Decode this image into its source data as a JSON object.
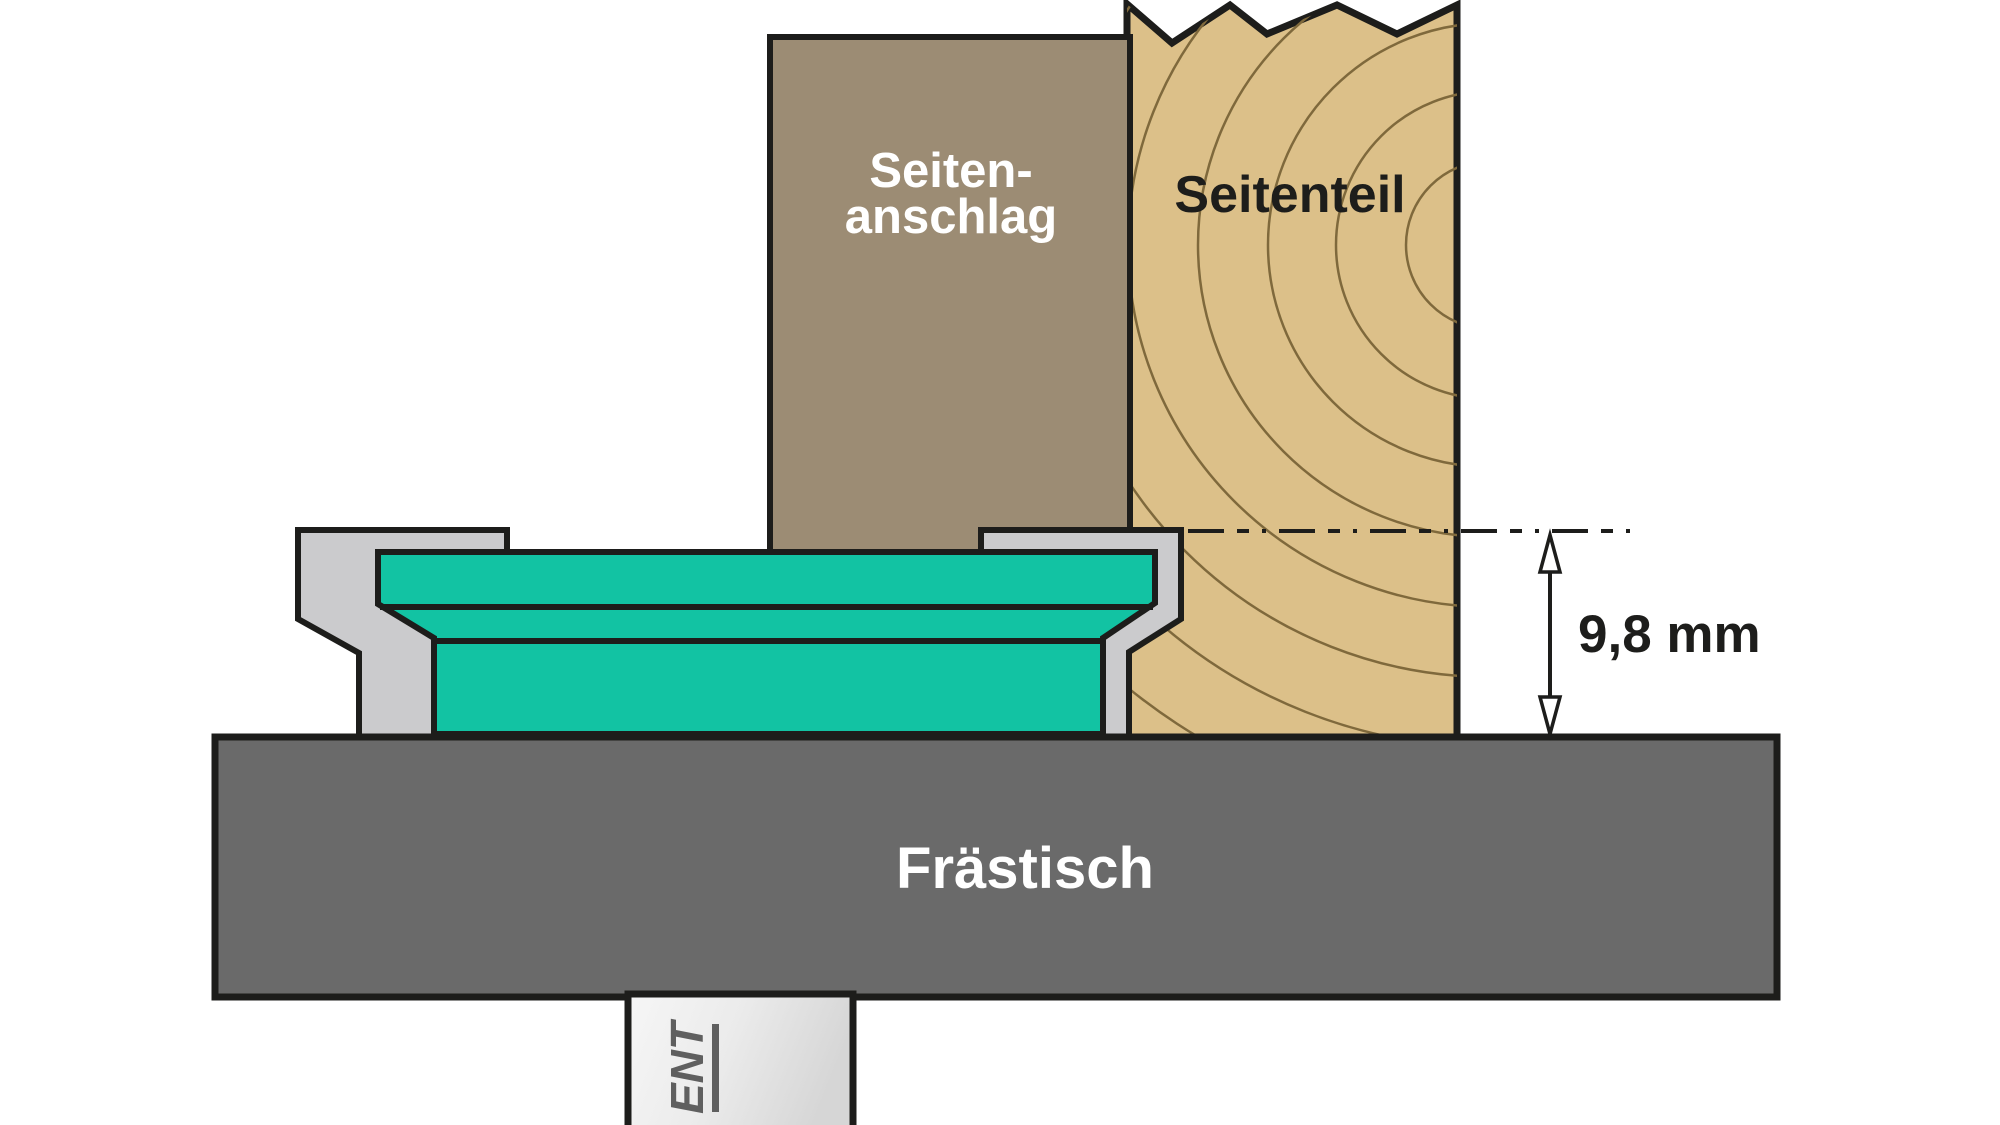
{
  "diagram": {
    "fence": {
      "label_line1": "Seiten-",
      "label_line2": "anschlag"
    },
    "workpiece": {
      "label": "Seitenteil"
    },
    "router_table": {
      "label": "Frästisch"
    },
    "dimension": {
      "label": "9,8 mm"
    },
    "spindle": {
      "brand": "ENT"
    }
  },
  "colors": {
    "fence_brown": "#9c8c74",
    "wood_tan": "#dcc089",
    "wood_grain": "#7f693c",
    "cutter_teal": "#12c3a3",
    "cutter_body_gray": "#cbcbcd",
    "table_gray": "#6a6a6a",
    "spindle_logo_gray": "#5f5f5f",
    "outline_black": "#1d1d1b",
    "label_white": "#ffffff",
    "label_black": "#1d1d1b"
  }
}
